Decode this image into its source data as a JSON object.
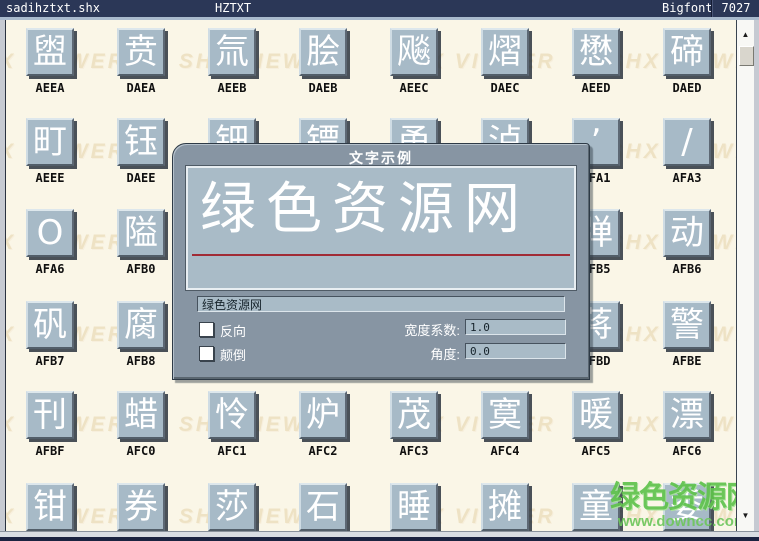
{
  "colors": {
    "titlebar_bg": "#2b3757",
    "content_bg": "#faf6e7",
    "tile_face": "#a7bac7",
    "dialog_frame": "#8795a3",
    "preview_bg": "#a9bbc7",
    "underline_red": "#a12b35",
    "watermark_tan": "#eee2c4",
    "watermark_green": "#5fc34c"
  },
  "titlebar": {
    "filename": "sadihztxt.shx",
    "font_name": "HZTXT",
    "font_type": "Bigfont",
    "glyph_count": "7027"
  },
  "watermark": {
    "tiled_text": "SHX VIEWER",
    "site_name": "绿色资源网",
    "site_url": "www.downcc.com"
  },
  "scrollbar": {
    "up_icon": "▲",
    "down_icon": "▼"
  },
  "grid": {
    "rows": [
      {
        "tiles": [
          {
            "glyph": "盥",
            "code": "AEEA"
          },
          {
            "glyph": "贲",
            "code": "DAEA"
          },
          {
            "glyph": "氚",
            "code": "AEEB"
          },
          {
            "glyph": "脍",
            "code": "DAEB"
          },
          {
            "glyph": "飚",
            "code": "AEEC"
          },
          {
            "glyph": "熠",
            "code": "DAEC"
          },
          {
            "glyph": "懋",
            "code": "AEED"
          },
          {
            "glyph": "碲",
            "code": "DAED"
          }
        ]
      },
      {
        "tiles": [
          {
            "glyph": "町",
            "code": "AEEE"
          },
          {
            "glyph": "钰",
            "code": "DAEE"
          },
          {
            "glyph": "钿",
            "code": ""
          },
          {
            "glyph": "镖",
            "code": ""
          },
          {
            "glyph": "甬",
            "code": ""
          },
          {
            "glyph": "泸",
            "code": ""
          },
          {
            "glyph": "’",
            "code": "AFA1"
          },
          {
            "glyph": "/",
            "code": "AFA3"
          }
        ]
      },
      {
        "tiles": [
          {
            "glyph": "O",
            "code": "AFA6"
          },
          {
            "glyph": "隘",
            "code": "AFB0"
          },
          {
            "glyph": "",
            "code": ""
          },
          {
            "glyph": "",
            "code": ""
          },
          {
            "glyph": "",
            "code": ""
          },
          {
            "glyph": "",
            "code": ""
          },
          {
            "glyph": "弹",
            "code": "AFB5"
          },
          {
            "glyph": "动",
            "code": "AFB6"
          }
        ]
      },
      {
        "tiles": [
          {
            "glyph": "矾",
            "code": "AFB7"
          },
          {
            "glyph": "腐",
            "code": "AFB8"
          },
          {
            "glyph": "",
            "code": ""
          },
          {
            "glyph": "",
            "code": ""
          },
          {
            "glyph": "",
            "code": ""
          },
          {
            "glyph": "",
            "code": ""
          },
          {
            "glyph": "蒋",
            "code": "AFBD"
          },
          {
            "glyph": "警",
            "code": "AFBE"
          }
        ]
      },
      {
        "tiles": [
          {
            "glyph": "刊",
            "code": "AFBF"
          },
          {
            "glyph": "蜡",
            "code": "AFC0"
          },
          {
            "glyph": "怜",
            "code": "AFC1"
          },
          {
            "glyph": "炉",
            "code": "AFC2"
          },
          {
            "glyph": "茂",
            "code": "AFC3"
          },
          {
            "glyph": "寞",
            "code": "AFC4"
          },
          {
            "glyph": "暖",
            "code": "AFC5"
          },
          {
            "glyph": "漂",
            "code": "AFC6"
          }
        ]
      },
      {
        "tiles": [
          {
            "glyph": "钳",
            "code": ""
          },
          {
            "glyph": "券",
            "code": ""
          },
          {
            "glyph": "莎",
            "code": ""
          },
          {
            "glyph": "石",
            "code": ""
          },
          {
            "glyph": "睡",
            "code": ""
          },
          {
            "glyph": "摊",
            "code": ""
          },
          {
            "glyph": "童",
            "code": ""
          },
          {
            "glyph": "委",
            "code": ""
          }
        ]
      }
    ]
  },
  "dialog": {
    "title": "文字示例",
    "preview_text": "绿色资源网",
    "text_input": {
      "value": "绿色资源网"
    },
    "checkboxes": [
      {
        "label": "反向",
        "checked": false
      },
      {
        "label": "颠倒",
        "checked": false
      }
    ],
    "fields": [
      {
        "label": "宽度系数:",
        "value": "1.0"
      },
      {
        "label": "角度:",
        "value": "0.0"
      }
    ]
  }
}
